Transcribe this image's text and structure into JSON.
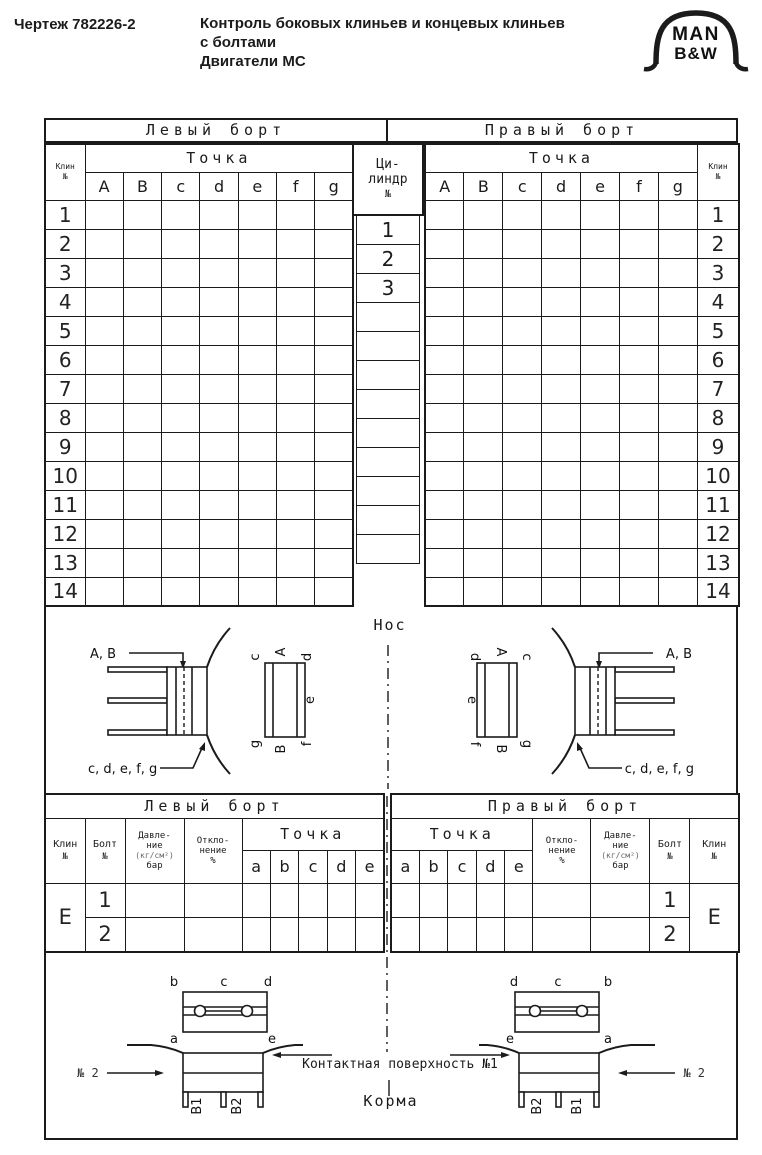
{
  "header": {
    "doc_number": "Чертеж 782226-2",
    "title_lines": [
      "Контроль боковых клиньев и концевых клиньев",
      "с болтами",
      "Двигатели МС"
    ],
    "logo": {
      "line1": "MAN",
      "line2": "B&W"
    }
  },
  "main_table": {
    "left_board": "Левый борт",
    "right_board": "Правый борт",
    "wedge_header": {
      "line1": "Клин",
      "line2": "№"
    },
    "point_header": "Точка",
    "point_columns": [
      "A",
      "B",
      "c",
      "d",
      "e",
      "f",
      "g"
    ],
    "cylinder_header": {
      "line1": "Ци-",
      "line2": "линдр",
      "line3": "№"
    },
    "cylinder_values": [
      "1",
      "2",
      "3",
      "",
      "",
      "",
      "",
      "",
      "",
      "",
      "",
      ""
    ],
    "row_numbers": [
      "1",
      "2",
      "3",
      "4",
      "5",
      "6",
      "7",
      "8",
      "9",
      "10",
      "11",
      "12",
      "13",
      "14"
    ]
  },
  "middle_diagrams": {
    "bow_label": "Нос",
    "ab_callout": "A, B",
    "cdefg_callout": "c, d, e, f, g",
    "left_plan": {
      "top_left": "c",
      "top_center": "A",
      "top_right": "d",
      "right_middle": "e",
      "bottom_right": "f",
      "bottom_center": "B",
      "bottom_left": "g"
    },
    "right_plan": {
      "top_left": "d",
      "top_center": "A",
      "top_right": "c",
      "left_middle": "e",
      "bottom_left": "f",
      "bottom_center": "B",
      "bottom_right": "g"
    }
  },
  "bolt_table": {
    "left_board": "Левый борт",
    "right_board": "Правый борт",
    "wedge_header": {
      "line1": "Клин",
      "line2": "№"
    },
    "bolt_header": {
      "line1": "Болт",
      "line2": "№"
    },
    "pressure_header": {
      "line1": "Давле-",
      "line2": "ние",
      "line3": "(кг/см²)",
      "line4": "бар"
    },
    "deviation_header": {
      "line1": "Откло-",
      "line2": "нение",
      "line3": "%"
    },
    "point_header": "Точка",
    "point_columns": [
      "a",
      "b",
      "c",
      "d",
      "e"
    ],
    "wedge_value": "E",
    "bolt_values": [
      "1",
      "2"
    ]
  },
  "bottom_diagrams": {
    "stern_label": "Корма",
    "contact_label": "Контактная поверхность №1",
    "no2_label": "№ 2",
    "left_plan": {
      "top_left": "b",
      "top_center": "c",
      "top_right": "d",
      "bottom_left": "a",
      "bottom_right": "e"
    },
    "right_plan": {
      "top_left": "d",
      "top_center": "c",
      "top_right": "b",
      "bottom_left": "e",
      "bottom_right": "a"
    },
    "left_legs": {
      "first": "В1",
      "second": "В2"
    },
    "right_legs": {
      "first": "В2",
      "second": "В1"
    }
  }
}
